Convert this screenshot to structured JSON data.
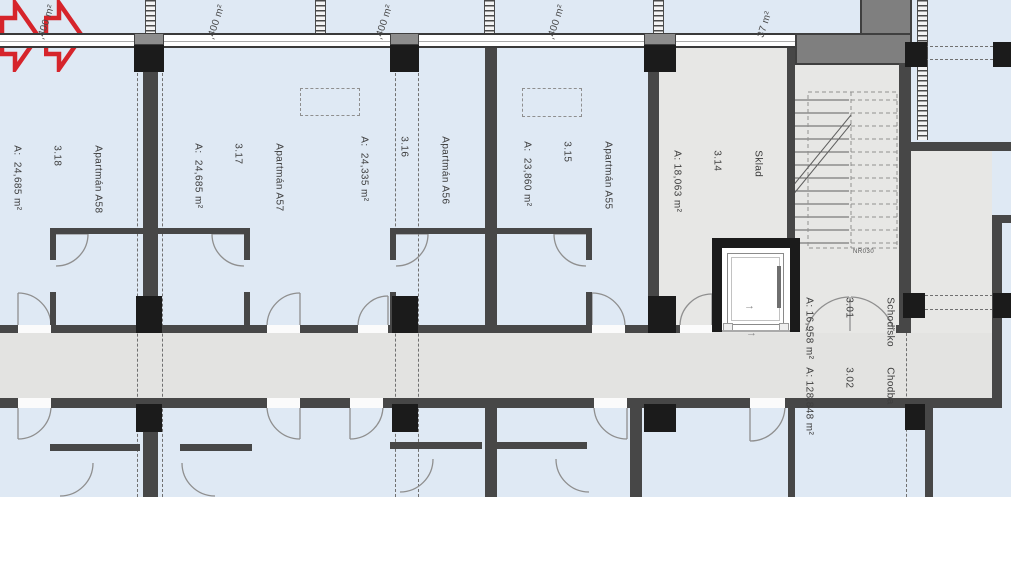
{
  "floorplan": {
    "balcony_labels": [
      ",400 m²",
      ",400 m²",
      ",400 m²",
      ",400 m²",
      "37 m²"
    ],
    "apartments": [
      {
        "name": "Apartmán A58",
        "number": "3.18",
        "area": "A:  24,685 m²"
      },
      {
        "name": "Apartmán A57",
        "number": "3.17",
        "area": "A:  24,685 m²"
      },
      {
        "name": "Apartmán A56",
        "number": "3.16",
        "area": "A:  24,335 m²"
      },
      {
        "name": "Apartmán A55",
        "number": "3.15",
        "area": "A:  23,860 m²"
      }
    ],
    "storage": {
      "name": "Sklad",
      "number": "3.14",
      "area": "A: 18,063 m²"
    },
    "staircase": {
      "name": "Schodisko",
      "number": "3.01",
      "area": "A: 16,958 m²",
      "stair_code": "NR030"
    },
    "corridor": {
      "name": "Chodba",
      "number": "3.02",
      "area": "A: 128,848 m²"
    },
    "direction_arrow": "→",
    "colors": {
      "highlight_arrow": "#d6242b",
      "wall": "#474747",
      "column": "#1b1b1b",
      "floor_blue": "#dfe9f4",
      "floor_gray": "#e3e3e1"
    }
  }
}
